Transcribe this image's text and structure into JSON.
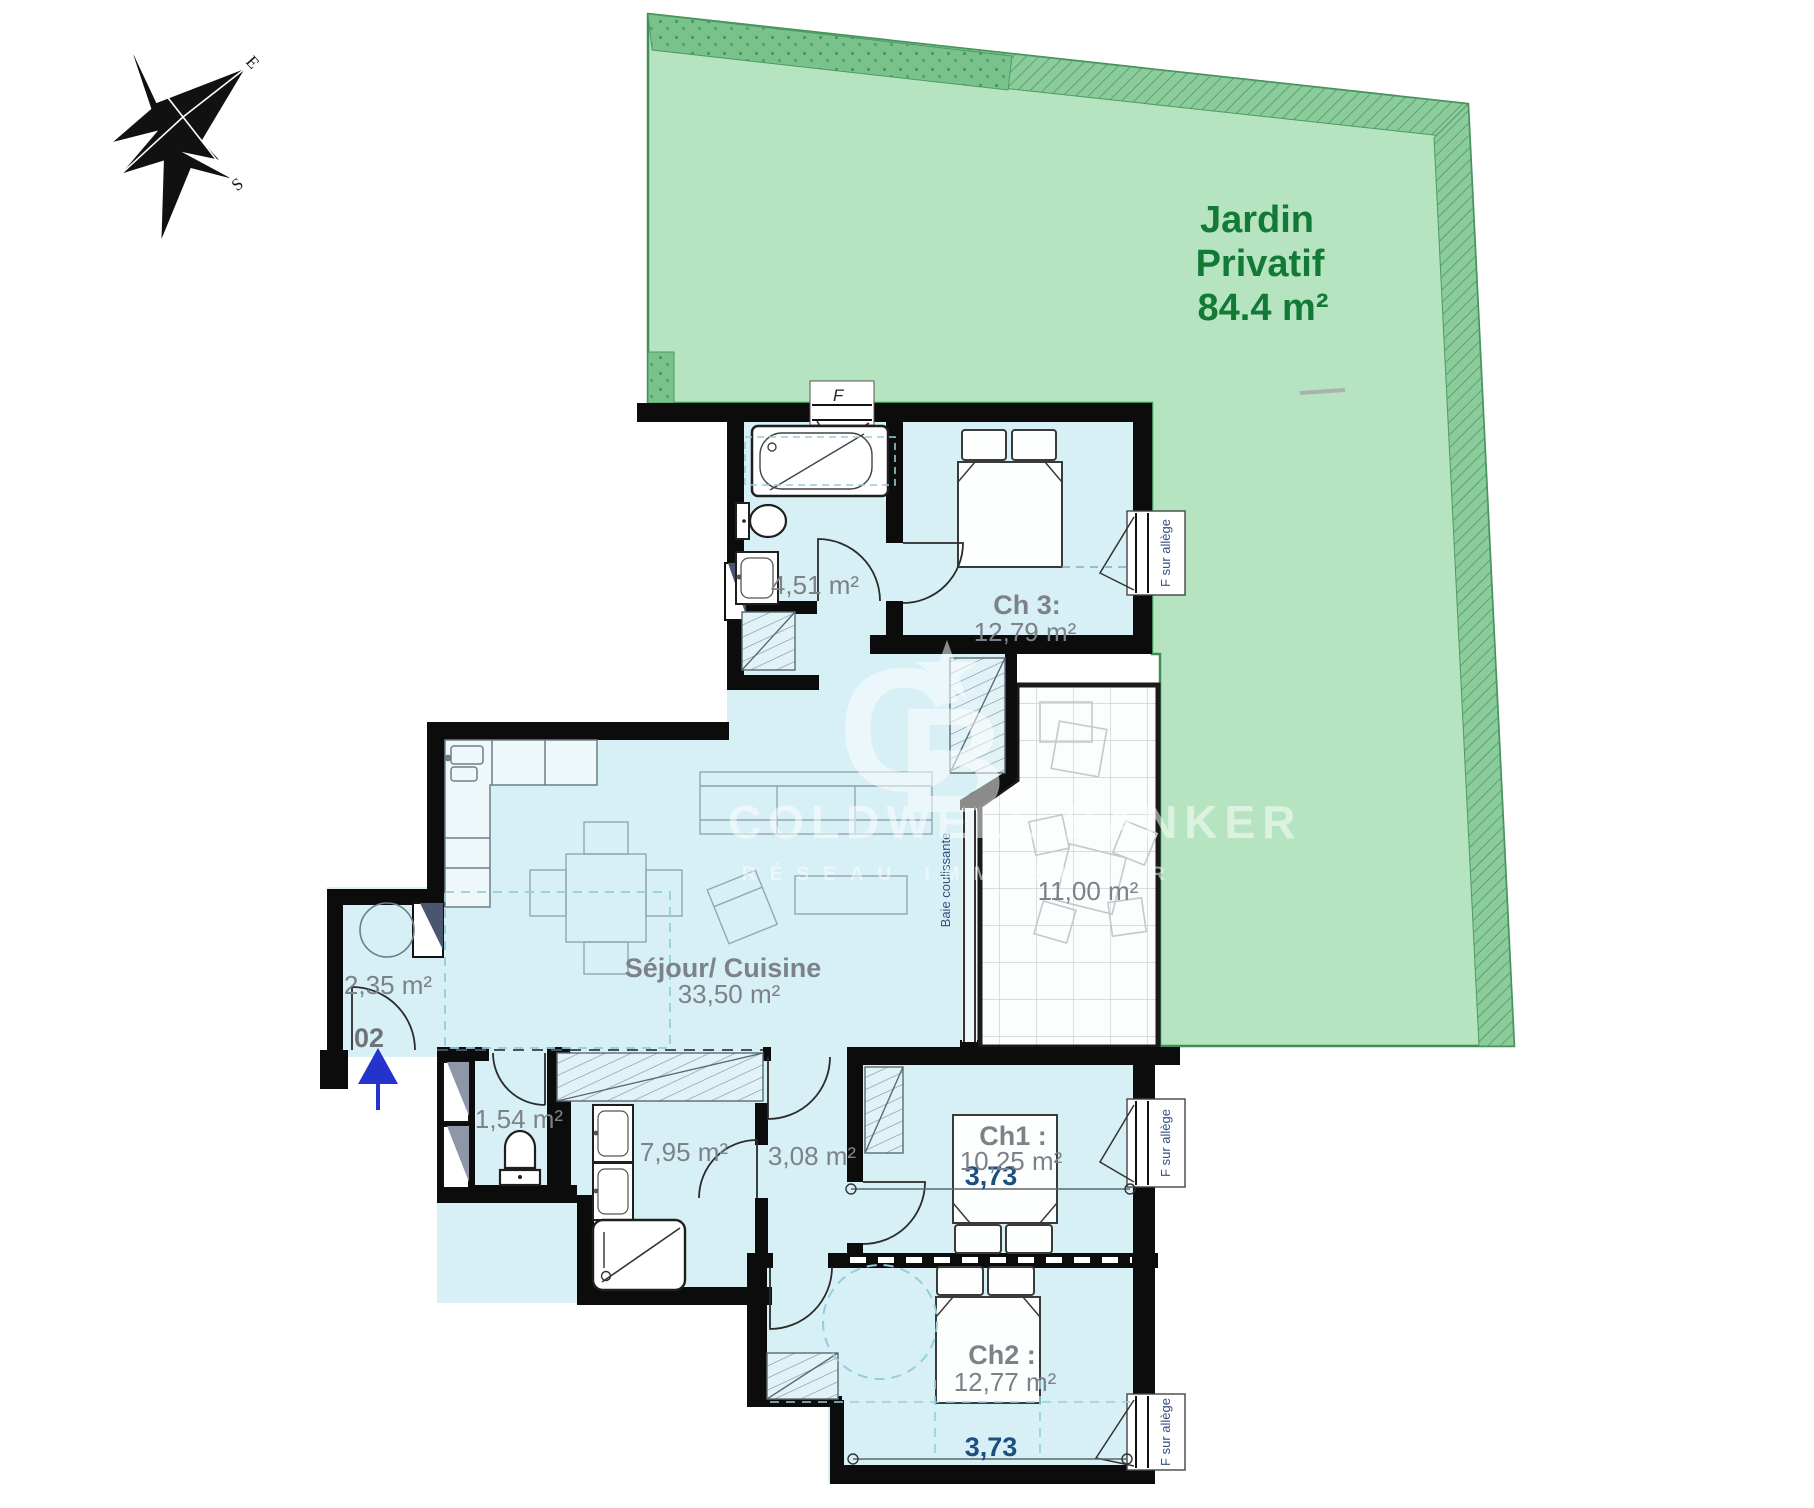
{
  "colors": {
    "wall": "#0c0c0c",
    "room_fill": "#d7f0f6",
    "garden_fill": "#b7e4c0",
    "garden_border": "#3f8f55",
    "garden_text": "#127a36",
    "label_gray": "#7c8287",
    "dimension_blue": "#1d4f80",
    "annotation_blue": "#33507e",
    "entry_arrow_blue": "#2333cc",
    "terrace_grid": "#ccd3d6"
  },
  "compass": {
    "east_label": "E",
    "south_label": "S"
  },
  "garden": {
    "title_line1": "Jardin",
    "title_line2": "Privatif",
    "area": "84.4 m²"
  },
  "watermark": {
    "monogram_c": "C",
    "monogram_b": "B",
    "brand": "COLDWELL BANKER",
    "tagline": "RÉSEAU IMMOBILIER"
  },
  "unit": {
    "number": "02"
  },
  "rooms": {
    "sejour": {
      "name": "Séjour/ Cuisine",
      "area": "33,50 m²"
    },
    "ch1": {
      "name": "Ch1 :",
      "area": "10,25 m²",
      "width": "3,73"
    },
    "ch2": {
      "name": "Ch2 :",
      "area": "12,77 m²",
      "width": "3,73"
    },
    "ch3": {
      "name": "Ch 3:",
      "area": "12,79 m²"
    },
    "bathroom": {
      "area": "4,51 m²"
    },
    "shower_room": {
      "area": "7,95 m²"
    },
    "hall": {
      "area": "3,08 m²"
    },
    "wc": {
      "area": "1,54 m²"
    },
    "entry": {
      "area": "2,35 m²"
    },
    "terrace": {
      "area": "11,00 m²"
    }
  },
  "annotations": {
    "window_tag": "F",
    "window_sill": "F sur allège",
    "sliding_bay": "Baie coulissante"
  }
}
